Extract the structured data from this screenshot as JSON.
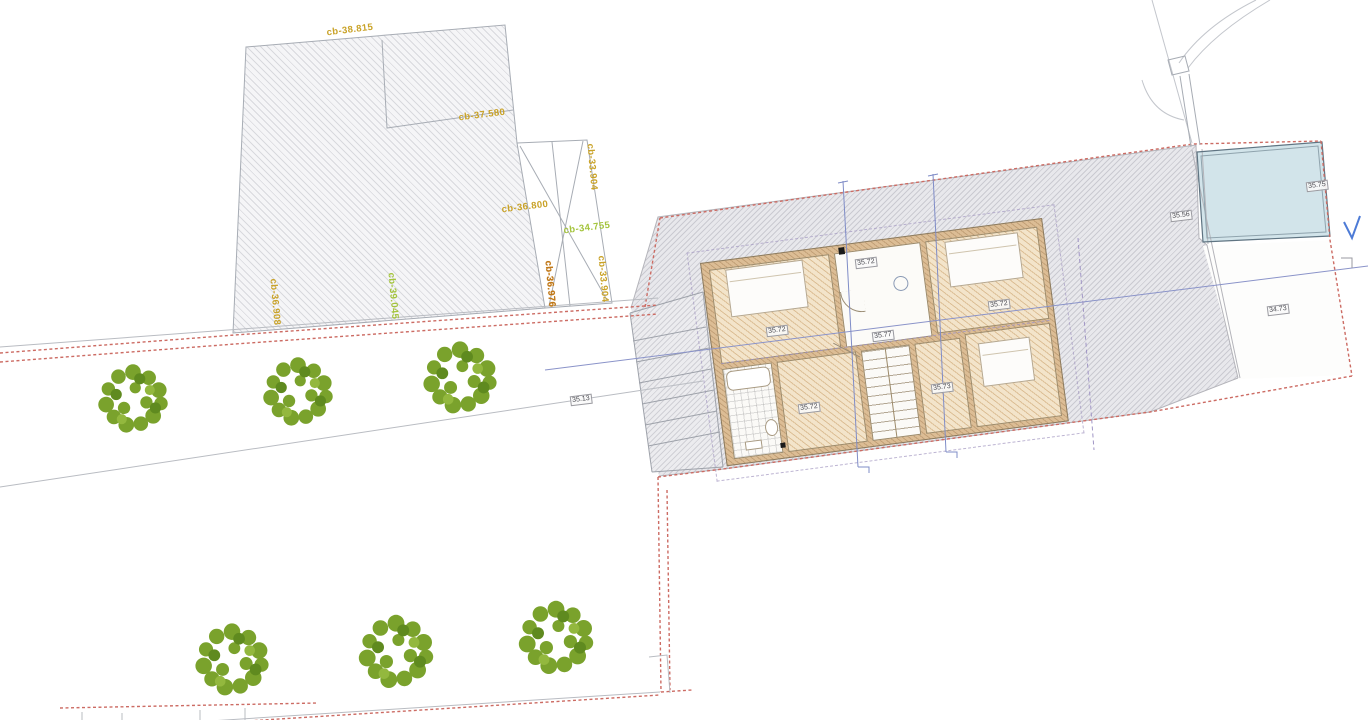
{
  "drawing": {
    "kind": "architectural site / floor plan",
    "colors": {
      "boundary_red": "#cc6b63",
      "terrace_gray": "#e8e8ec",
      "pool_blue": "#d2e4ea",
      "house_wall_tan": "#dcbd95",
      "house_floor_tan": "#f3e4ca",
      "tree_green": "#7aa22c",
      "level_label_orange": "#c9a227",
      "level_label_green": "#a4c43c",
      "level_label_bold_orange": "#c07818",
      "section_line_blue": "#7f8cc7"
    }
  },
  "site_labels": [
    {
      "text": "cb-38.815",
      "color": "orange"
    },
    {
      "text": "cb-37.580",
      "color": "orange"
    },
    {
      "text": "cb-36.800",
      "color": "orange"
    },
    {
      "text": "cb-34.755",
      "color": "green"
    },
    {
      "text": "cb-33.904",
      "color": "orange"
    },
    {
      "text": "cb-33.904",
      "color": "orange"
    },
    {
      "text": "cb-36.976",
      "color": "boldorange"
    },
    {
      "text": "cb-36.908",
      "color": "orange"
    },
    {
      "text": "cb-39.045",
      "color": "green"
    }
  ],
  "spot_levels": [
    {
      "text": "35.72",
      "location": "hall"
    },
    {
      "text": "35.72",
      "location": "bedroom-top-left"
    },
    {
      "text": "35.77",
      "location": "corridor-middle"
    },
    {
      "text": "35.72",
      "location": "bedroom-top-right"
    },
    {
      "text": "35.72",
      "location": "room-bottom-left"
    },
    {
      "text": "35.73",
      "location": "room-bottom-right"
    },
    {
      "text": "35.13",
      "location": "terrain-left"
    },
    {
      "text": "35.56",
      "location": "terrace-strip"
    },
    {
      "text": "35.75",
      "location": "pool-edge"
    },
    {
      "text": "34.73",
      "location": "courtyard"
    }
  ]
}
